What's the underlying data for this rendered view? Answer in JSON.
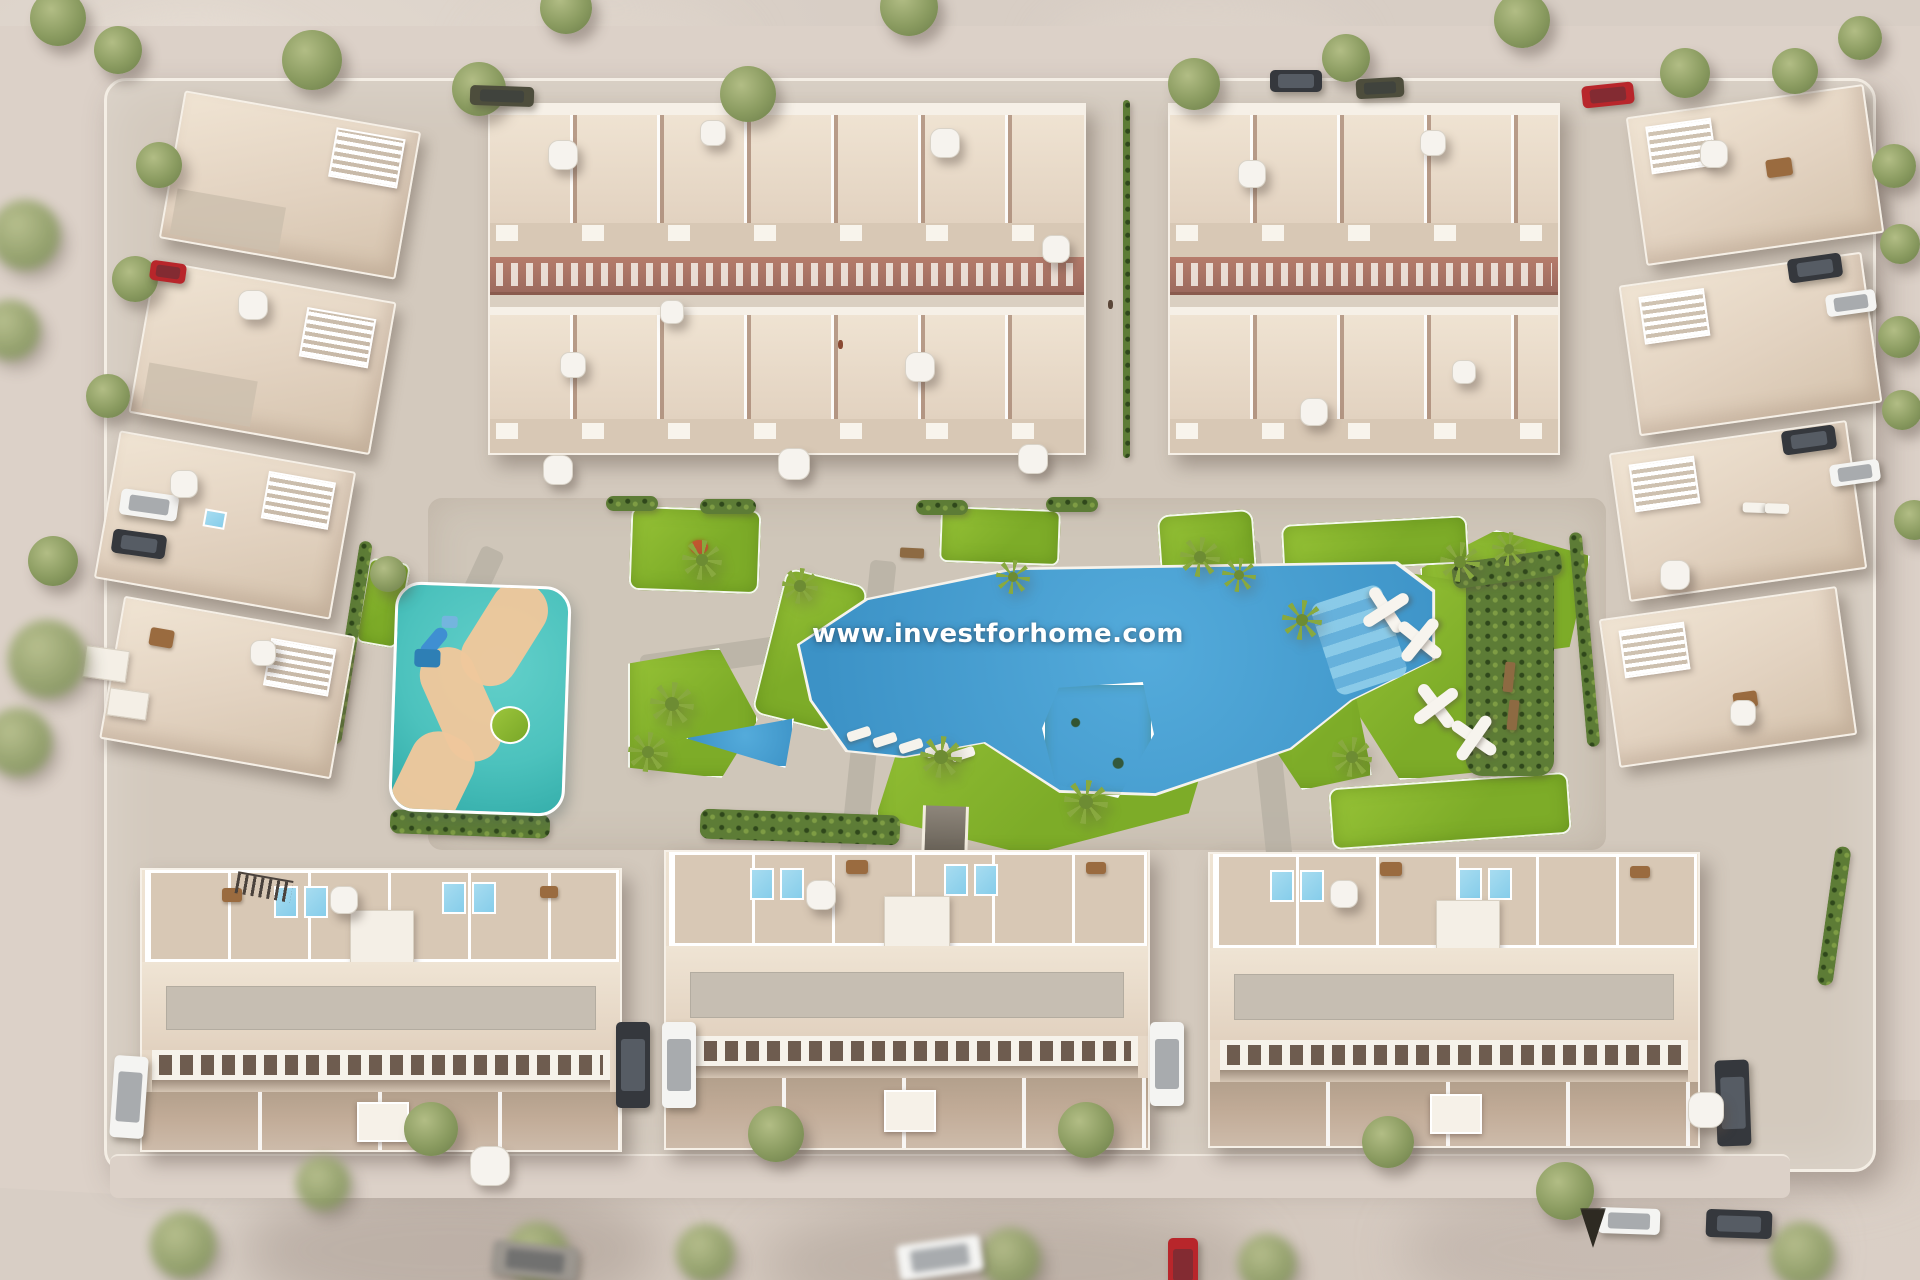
{
  "watermark": {
    "text": "www.investforhome.com"
  },
  "palette": {
    "ground": "#d8cec5",
    "road": "#dcd1c8",
    "paving": "#d3c9bd",
    "plaza": "#cfc6b9",
    "path": "#b9b2a6",
    "lawn": "#7dac28",
    "lawn_light": "#97c337",
    "pool": "#54abdb",
    "pool_deep": "#3c92c6",
    "pool_steps": "#8ecde9",
    "kids_pool": "#4cc2bd",
    "kids_pool_deep": "#2fa9a6",
    "kids_path": "#eec79c",
    "roof": "#e2d2c0",
    "terrace": "#d8c8b5",
    "wall": "#f6f0e7",
    "facade": "#b67c6c",
    "facade_dark": "#9c6a5e",
    "front_wall": "#c1ab97",
    "window_dark": "#6e5c4f",
    "rooftop_pool": "#86cdea",
    "tree": "#8a9b60",
    "tree_dark": "#6b7d49",
    "palm": "#88a93f",
    "hedge": "#5d7c36",
    "car_white": "#f4f4f2",
    "car_dark": "#35383d",
    "car_red": "#b8262b",
    "watermark_color": "#ffffff"
  }
}
